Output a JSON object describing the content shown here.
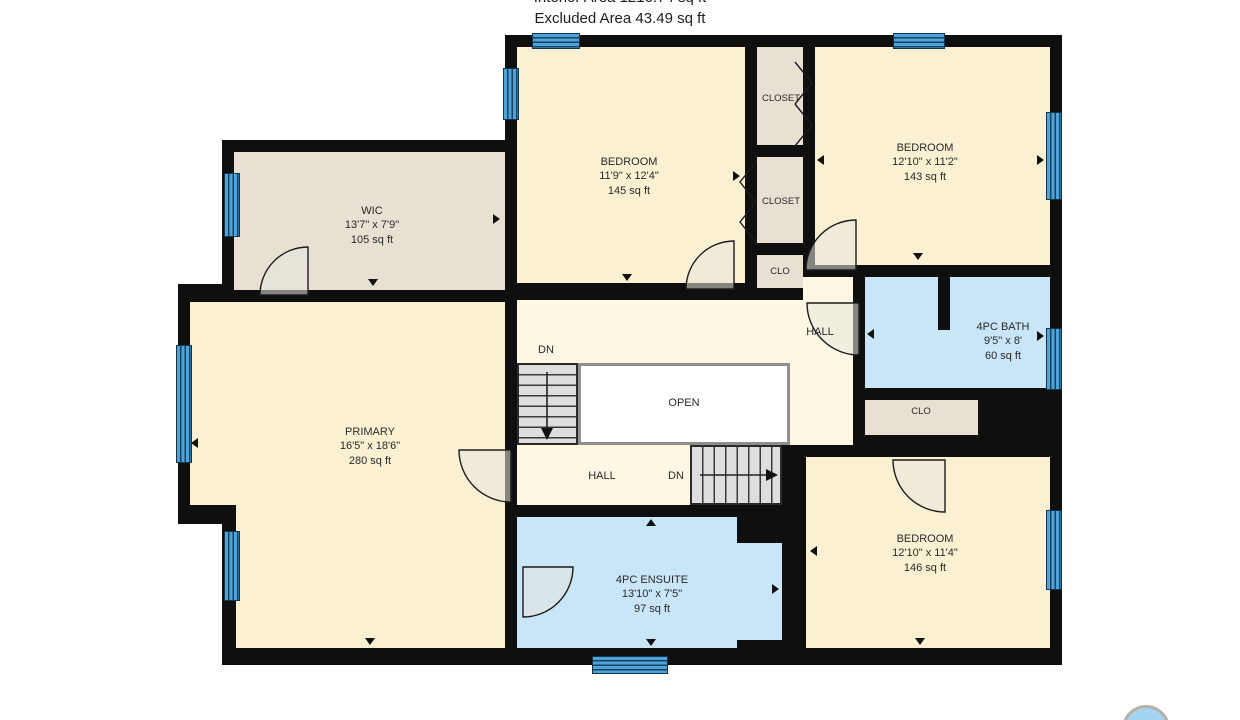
{
  "header": {
    "line1": "Interior Area 1216.74 sq ft",
    "line2": "Excluded Area 43.49 sq ft"
  },
  "rooms": {
    "wic": {
      "name": "WIC",
      "dims": "13'7\" x 7'9\"",
      "area": "105 sq ft"
    },
    "bedroom_top": {
      "name": "BEDROOM",
      "dims": "11'9\" x 12'4\"",
      "area": "145 sq ft"
    },
    "bedroom_right": {
      "name": "BEDROOM",
      "dims": "12'10\" x 11'2\"",
      "area": "143 sq ft"
    },
    "primary": {
      "name": "PRIMARY",
      "dims": "16'5\" x 18'6\"",
      "area": "280 sq ft"
    },
    "bath": {
      "name": "4PC BATH",
      "dims": "9'5\" x 8'",
      "area": "60 sq ft"
    },
    "ensuite": {
      "name": "4PC ENSUITE",
      "dims": "13'10\" x 7'5\"",
      "area": "97 sq ft"
    },
    "bedroom_bottom": {
      "name": "BEDROOM",
      "dims": "12'10\" x 11'4\"",
      "area": "146 sq ft"
    }
  },
  "labels": {
    "closet1": "CLOSET",
    "closet2": "CLOSET",
    "clo_top": "CLO",
    "clo_mid": "CLO",
    "hall_upper": "HALL",
    "hall_lower": "HALL",
    "open": "OPEN",
    "dn_upper": "DN",
    "dn_lower": "DN"
  },
  "colors": {
    "wall": "#0f0f0f",
    "room_cream": "#FBF0D2",
    "hall_cream": "#FDF7E3",
    "closet_beige": "#E8E0D2",
    "bath_blue": "#C9E5F8",
    "window_blue": "#4FA3D9",
    "stair_gray": "#DEDEDE",
    "logo_blue": "#A5D3F2"
  }
}
